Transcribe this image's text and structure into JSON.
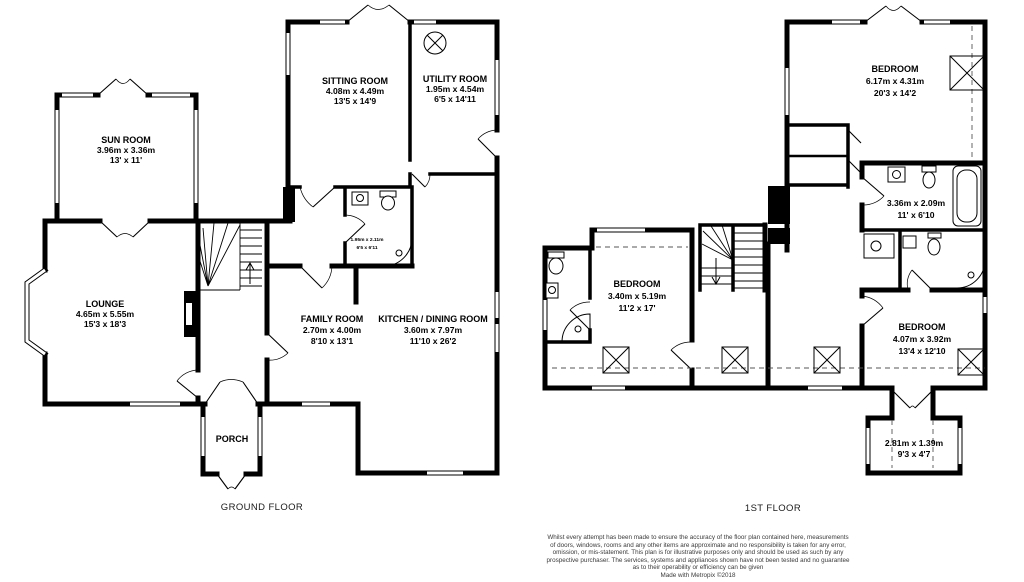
{
  "floors": {
    "ground": {
      "label": "GROUND FLOOR",
      "rooms": {
        "sun_room": {
          "name": "SUN ROOM",
          "metric": "3.96m x 3.36m",
          "imperial": "13' x 11'"
        },
        "lounge": {
          "name": "LOUNGE",
          "metric": "4.65m x 5.55m",
          "imperial": "15'3 x 18'3"
        },
        "sitting_room": {
          "name": "SITTING ROOM",
          "metric": "4.08m x 4.49m",
          "imperial": "13'5 x 14'9"
        },
        "utility_room": {
          "name": "UTILITY ROOM",
          "metric": "1.95m x 4.54m",
          "imperial": "6'5 x 14'11"
        },
        "family_room": {
          "name": "FAMILY ROOM",
          "metric": "2.70m x 4.00m",
          "imperial": "8'10 x 13'1"
        },
        "kitchen_dining_room": {
          "name": "KITCHEN / DINING ROOM",
          "metric": "3.60m x 7.97m",
          "imperial": "11'10 x 26'2"
        },
        "shower_room": {
          "metric": "1.95m x 2.11m",
          "imperial": "6'5 x 6'11"
        },
        "porch": {
          "name": "PORCH"
        }
      }
    },
    "first": {
      "label": "1ST FLOOR",
      "rooms": {
        "bedroom_main": {
          "name": "BEDROOM",
          "metric": "6.17m x 4.31m",
          "imperial": "20'3 x 14'2"
        },
        "bathroom": {
          "metric": "3.36m x 2.09m",
          "imperial": "11' x 6'10"
        },
        "bedroom_left": {
          "name": "BEDROOM",
          "metric": "3.40m x 5.19m",
          "imperial": "11'2 x 17'"
        },
        "bedroom_right": {
          "name": "BEDROOM",
          "metric": "4.07m x 3.92m",
          "imperial": "13'4 x 12'10"
        },
        "box_room": {
          "metric": "2.81m x 1.39m",
          "imperial": "9'3 x 4'7"
        }
      }
    }
  },
  "footer": {
    "disclaimer_lines": [
      "Whilst every attempt has been made to ensure the accuracy of the floor plan contained here, measurements",
      "of doors, windows, rooms and any other items are approximate and no responsibility is taken for any error,",
      "omission, or mis-statement. This plan is for illustrative purposes only and should be used as such by any",
      "prospective purchaser. The services, systems and appliances shown have not been tested and no guarantee",
      "as to their operability or efficiency can be given"
    ],
    "credit": "Made with Metropix ©2018"
  },
  "colors": {
    "wall": "#000000",
    "background": "#ffffff",
    "text": "#000000",
    "muted_text": "#3a3a3a"
  }
}
